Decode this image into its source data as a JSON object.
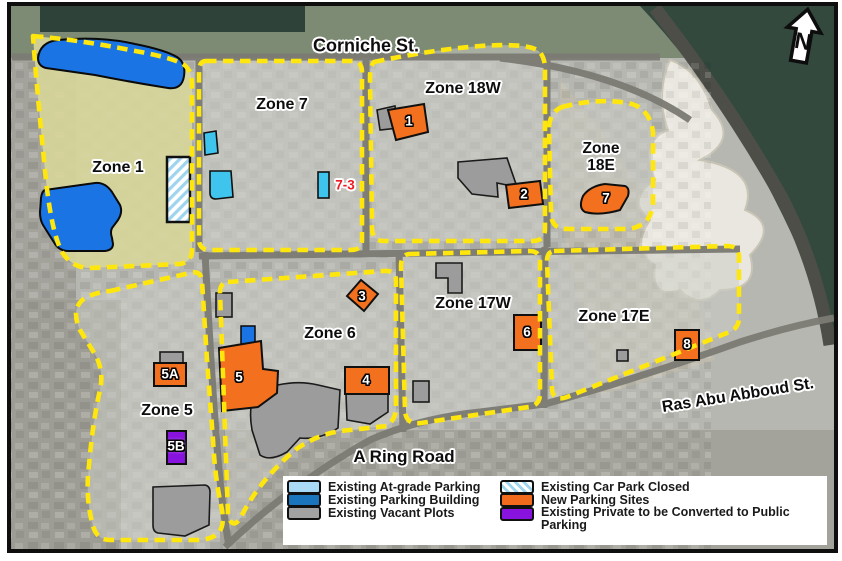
{
  "north": {
    "label": "N"
  },
  "streets": {
    "corniche": "Corniche St.",
    "a_ring_road": "A Ring Road",
    "ras_abu_abboud": "Ras Abu Abboud St."
  },
  "zones": {
    "zone1": "Zone 1",
    "zone5": "Zone 5",
    "zone6": "Zone 6",
    "zone7": "Zone 7",
    "zone17w": "Zone 17W",
    "zone17e": "Zone 17E",
    "zone18w": "Zone 18W",
    "zone18e": "Zone\n18E"
  },
  "sites": {
    "new_parking": {
      "s1": "1",
      "s2": "2",
      "s3": "3",
      "s4": "4",
      "s5": "5",
      "s5a": "5A",
      "s6": "6",
      "s7": "7",
      "s8": "8"
    },
    "converted_private": {
      "s5b": "5B"
    },
    "at_grade": {
      "s73": "7-3"
    }
  },
  "legend": {
    "items": [
      {
        "label": "Existing At-grade Parking",
        "color": "#a9d9f5"
      },
      {
        "label": "Existing Parking Building",
        "color": "#1b75bc"
      },
      {
        "label": "Existing Vacant Plots",
        "color": "#a2a2a2"
      },
      {
        "label": "Existing Car Park Closed",
        "color": "#ffffff",
        "hatch_color": "#9fd4ef"
      },
      {
        "label": "New Parking Sites",
        "color": "#f26a1b"
      },
      {
        "label": "Existing Private to be Converted to Public Parking",
        "color": "#8812de"
      }
    ]
  },
  "colors": {
    "zone_boundary_dash": "#ffe70d",
    "zone1_overlay": "#d8d69a",
    "new_parking_site": "#f3701e",
    "existing_parking_building": "#1a74e4",
    "existing_at_grade_parking": "#3fc4ee",
    "existing_vacant_plot": "#9c9c9c",
    "private_to_public": "#8812de",
    "site_7_3_text": "#ed1c24",
    "water": "#33493e"
  }
}
